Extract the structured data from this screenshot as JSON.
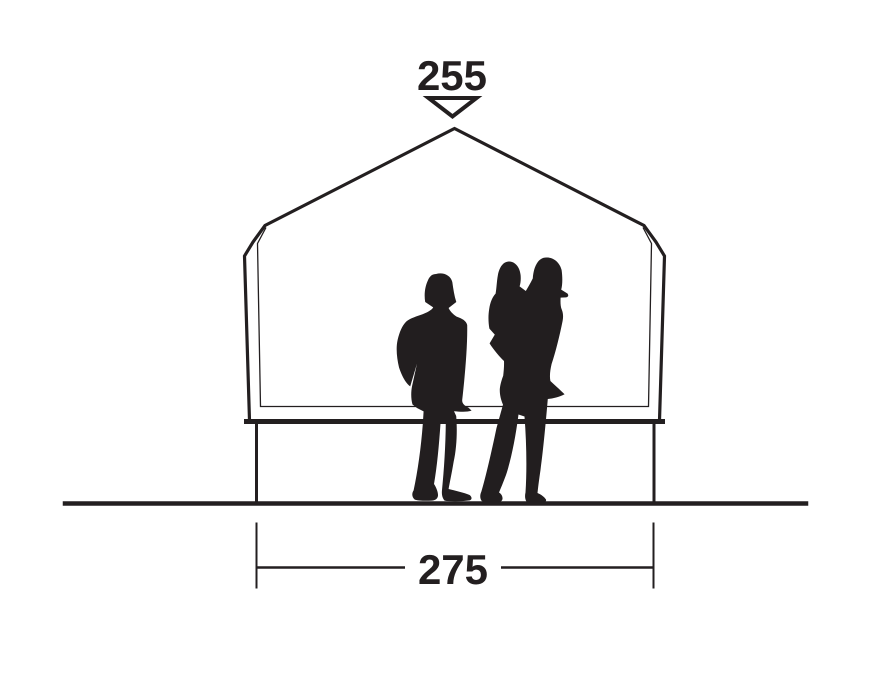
{
  "page": {
    "background_color": "#ffffff"
  },
  "diagram": {
    "name": "tent-front-elevation-dimension-diagram",
    "line_color": "#231f20",
    "silhouette_color": "#221e1f",
    "height_dimension": {
      "label": "255",
      "marker_icon": "down-triangle-arrow"
    },
    "width_dimension": {
      "label": "275"
    },
    "figures": [
      {
        "icon": "standing-person-silhouette"
      },
      {
        "icon": "adult-carrying-child-silhouette"
      }
    ]
  }
}
